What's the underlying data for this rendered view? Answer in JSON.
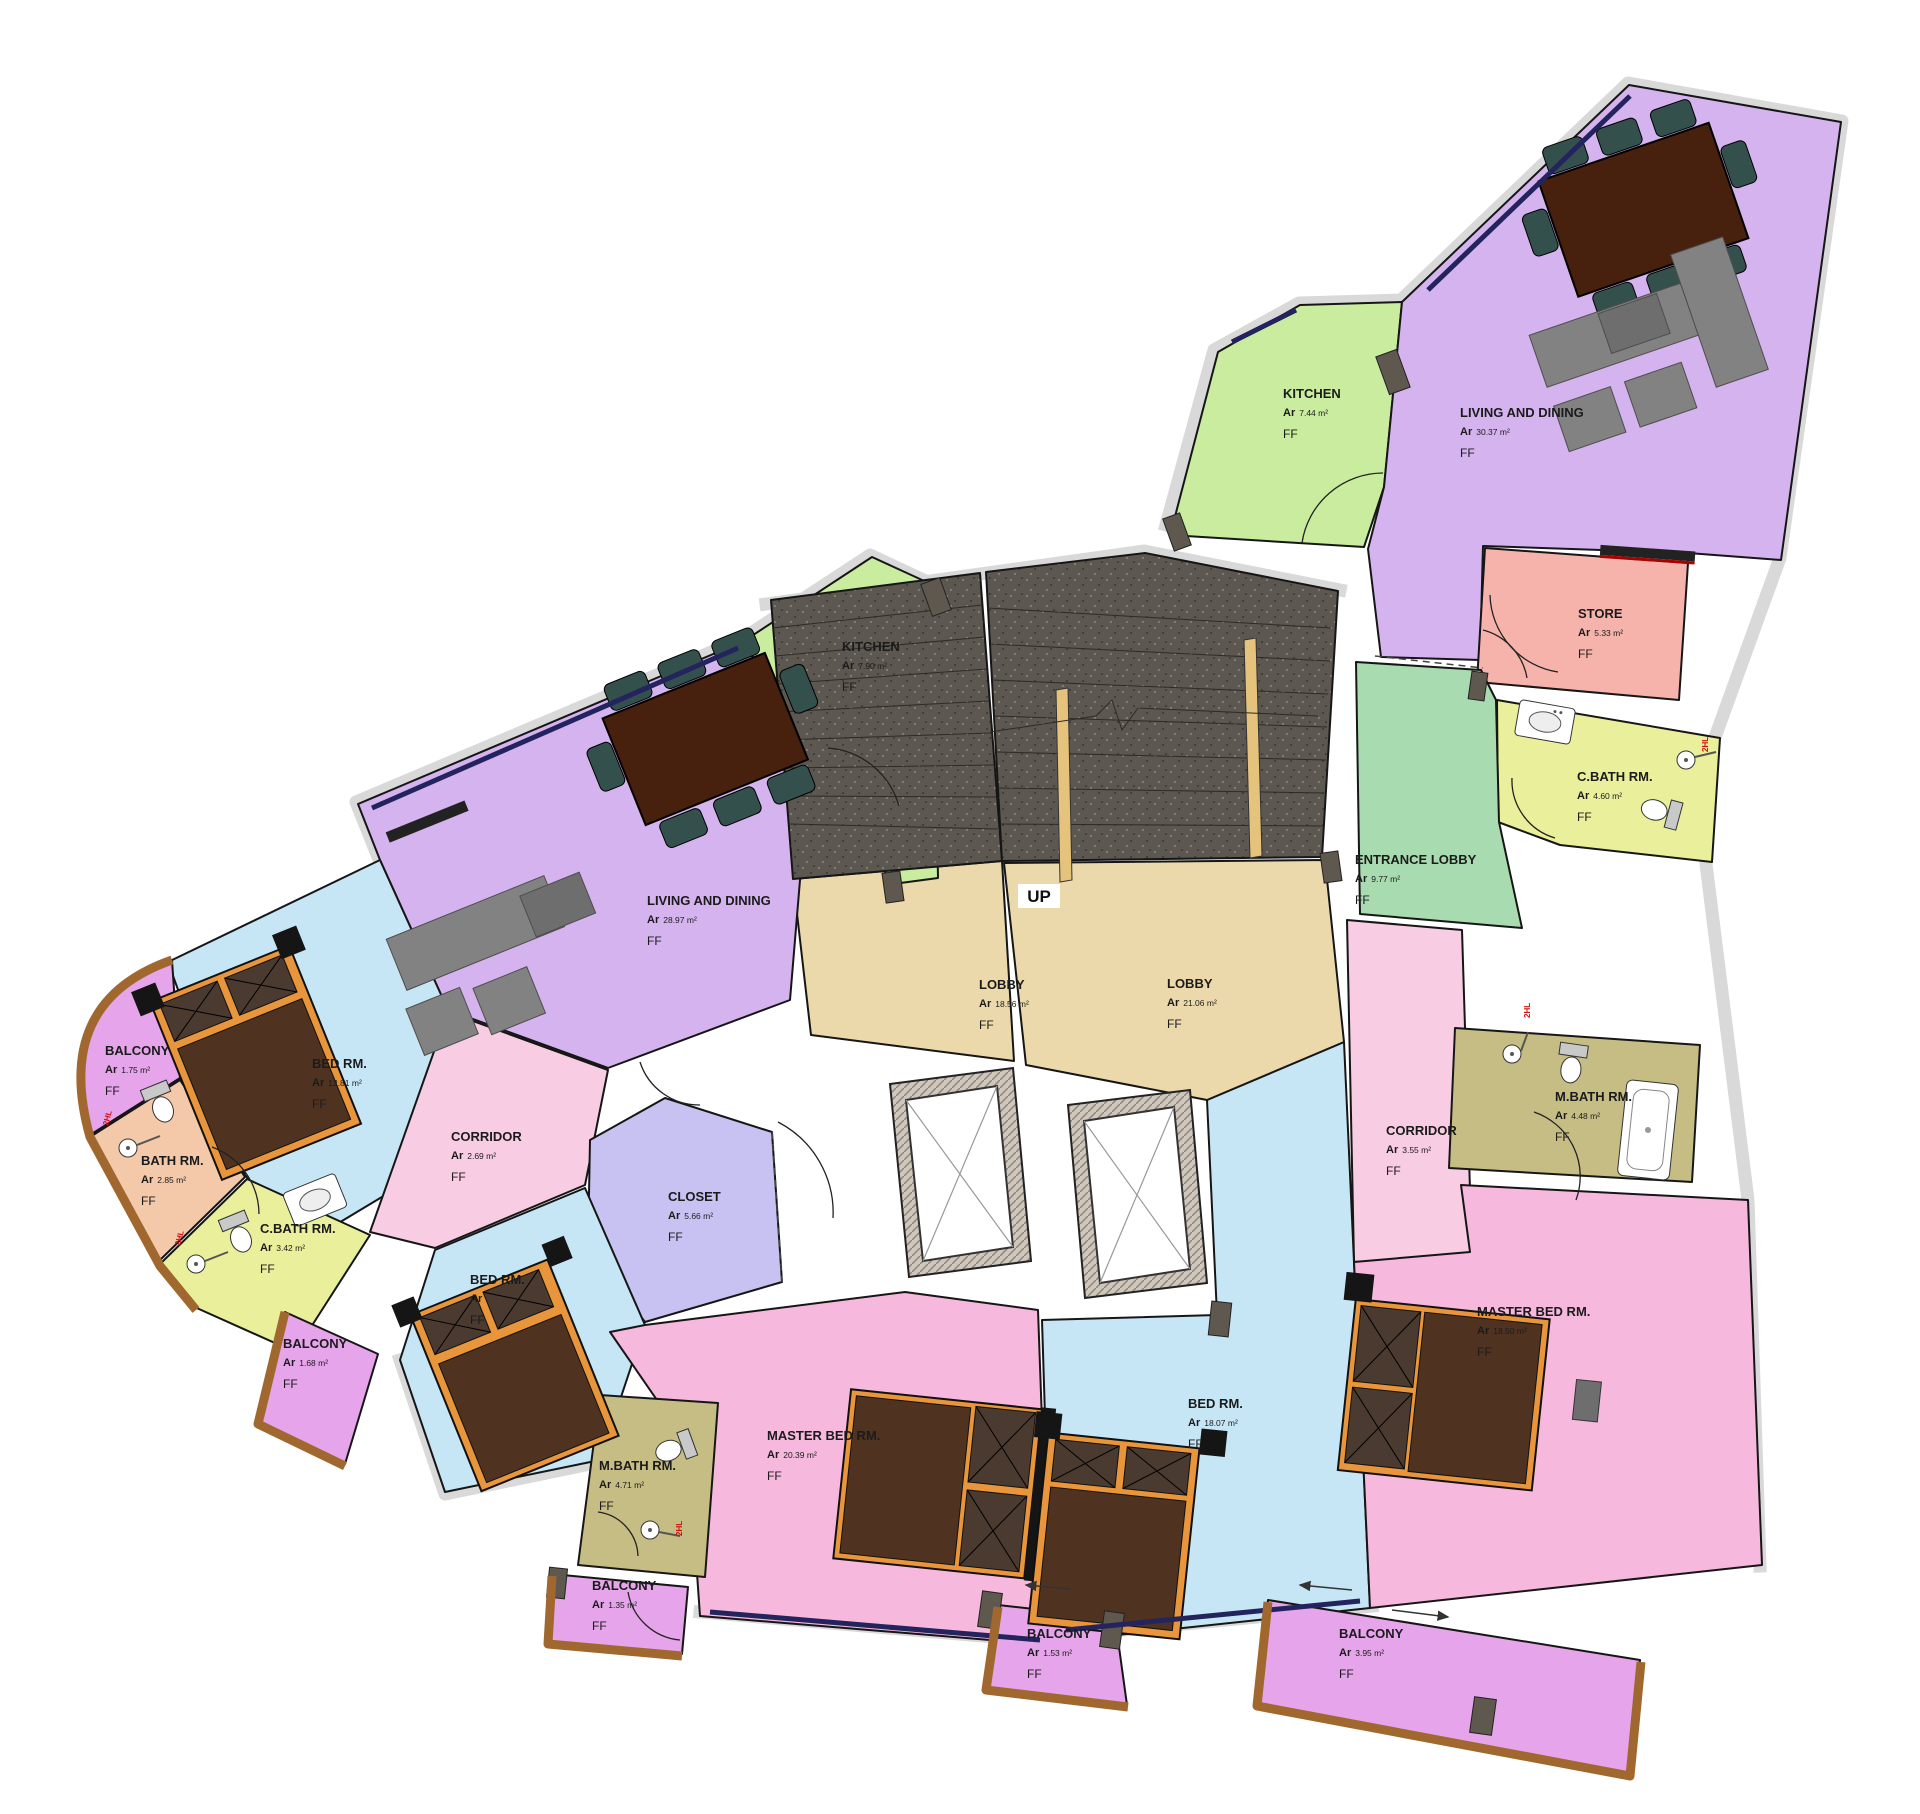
{
  "plan": {
    "title": "First floor apartment plan",
    "area_prefix": "Ar",
    "floor_tag": "FF",
    "up_label": "UP",
    "marker_label": "2HL",
    "accent_colors": {
      "living": "#d5b3ef",
      "kitchen": "#c9ec9e",
      "lobby": "#ecd9ab",
      "entrance_lobby": "#a8dcb0",
      "store": "#f5b3ac",
      "cbath": "#e9ef9a",
      "bed": "#c6e6f6",
      "master": "#f6b8dc",
      "corridor": "#f8cce2",
      "mbath": "#c6bd85",
      "balcony": "#e6a4ea",
      "bath": "#f3c9a9",
      "closet": "#c7c2f2",
      "stairs": "#5d5751",
      "walls": "#d9d9d9"
    },
    "rooms": [
      {
        "name": "KITCHEN",
        "area": "7.44 m²"
      },
      {
        "name": "LIVING AND DINING",
        "area": "30.37 m²"
      },
      {
        "name": "STORE",
        "area": "5.33 m²"
      },
      {
        "name": "C.BATH RM.",
        "area": "4.60 m²"
      },
      {
        "name": "ENTRANCE LOBBY",
        "area": "9.77 m²"
      },
      {
        "name": "LOBBY",
        "area": "18.56 m²"
      },
      {
        "name": "LOBBY",
        "area": "21.06 m²"
      },
      {
        "name": "KITCHEN",
        "area": "7.90 m²"
      },
      {
        "name": "LIVING AND DINING",
        "area": "28.97 m²"
      },
      {
        "name": "BED RM.",
        "area": "12.81 m²"
      },
      {
        "name": "BALCONY",
        "area": "1.75 m²"
      },
      {
        "name": "BATH RM.",
        "area": "2.85 m²"
      },
      {
        "name": "C.BATH RM.",
        "area": "3.42 m²"
      },
      {
        "name": "CORRIDOR",
        "area": "2.69 m²"
      },
      {
        "name": "CLOSET",
        "area": "5.66 m²"
      },
      {
        "name": "BED RM.",
        "area": ""
      },
      {
        "name": "M.BATH RM.",
        "area": "4.71 m²"
      },
      {
        "name": "MASTER BED RM.",
        "area": "20.39 m²"
      },
      {
        "name": "BED RM.",
        "area": "18.07 m²"
      },
      {
        "name": "MASTER BED RM.",
        "area": "18.50 m²"
      },
      {
        "name": "CORRIDOR",
        "area": "3.55 m²"
      },
      {
        "name": "M.BATH RM.",
        "area": "4.48 m²"
      },
      {
        "name": "BALCONY",
        "area": "1.68 m²"
      },
      {
        "name": "BALCONY",
        "area": "1.35 m²"
      },
      {
        "name": "BALCONY",
        "area": "1.53 m²"
      },
      {
        "name": "BALCONY",
        "area": "3.95 m²"
      }
    ]
  }
}
